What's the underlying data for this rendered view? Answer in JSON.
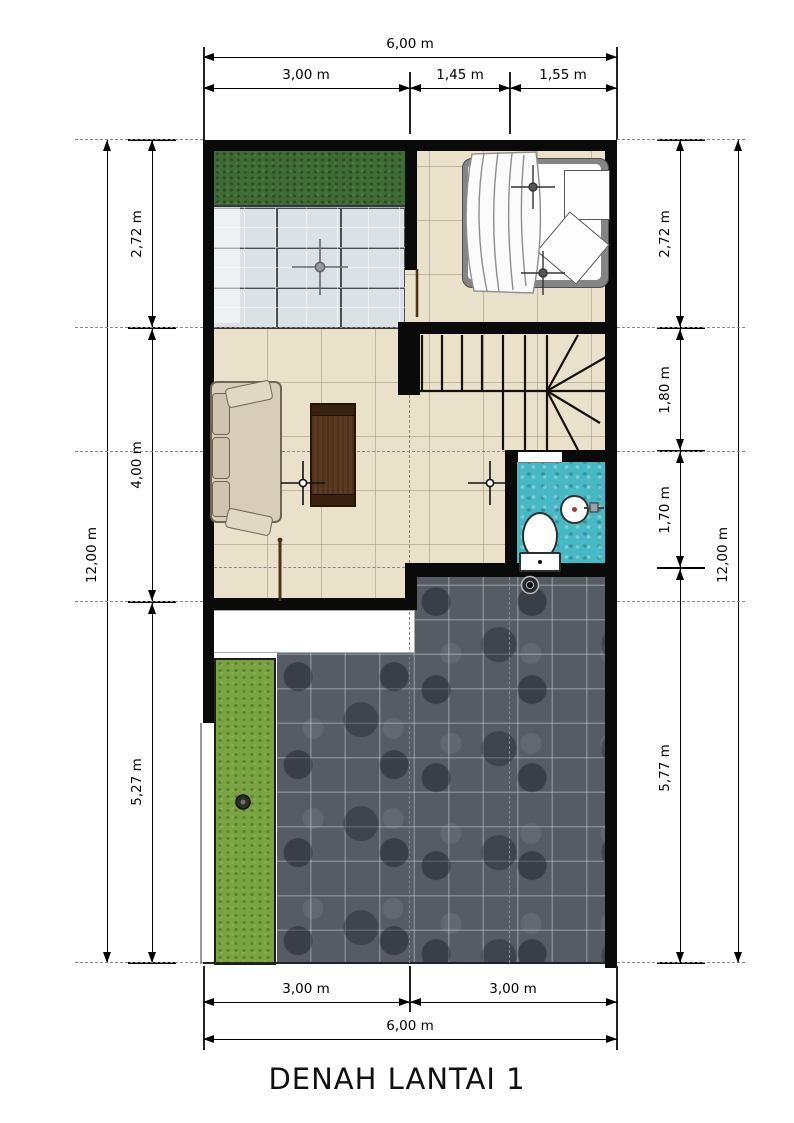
{
  "title": "DENAH LANTAI 1",
  "dimensions": {
    "top": {
      "total": "6,00 m",
      "segments": [
        "3,00 m",
        "1,45 m",
        "1,55 m"
      ]
    },
    "bottom": {
      "total": "6,00 m",
      "segments": [
        "3,00 m",
        "3,00 m"
      ]
    },
    "left": {
      "total": "12,00 m",
      "segments": [
        "2,72 m",
        "4,00 m",
        "5,27 m"
      ]
    },
    "right": {
      "total": "12,00 m",
      "segments": [
        "2,72 m",
        "1,80 m",
        "1,70 m",
        "5,77 m"
      ]
    }
  },
  "colors": {
    "wall": "#0a0a0a",
    "floor-tile": "#eae1cb",
    "grass-dark": "#3f6b34",
    "grass-light": "#7aa441",
    "glass": "#dce1e6",
    "dark-tile": "#565c64",
    "bath-tile": "#48b8c4",
    "wood": "#5b3a20",
    "sofa": "#d7cdb8",
    "terrace": "#ffffff",
    "dashed-line": "#888888"
  },
  "elements": {
    "bed": "double-bed",
    "nightstand": "nightstand",
    "pillow": "pillow",
    "sofa": "l-sofa",
    "coffee_table": "coffee-table",
    "toilet": "toilet",
    "sink": "wash-basin",
    "stairs": "winder-staircase",
    "drain": "floor-drain",
    "top_garden": "grass-strip",
    "side_garden": "grass-strip",
    "glass_canopy": "glass-roof",
    "carport": "dark-tile-paving",
    "terrace": "white-terrace"
  }
}
